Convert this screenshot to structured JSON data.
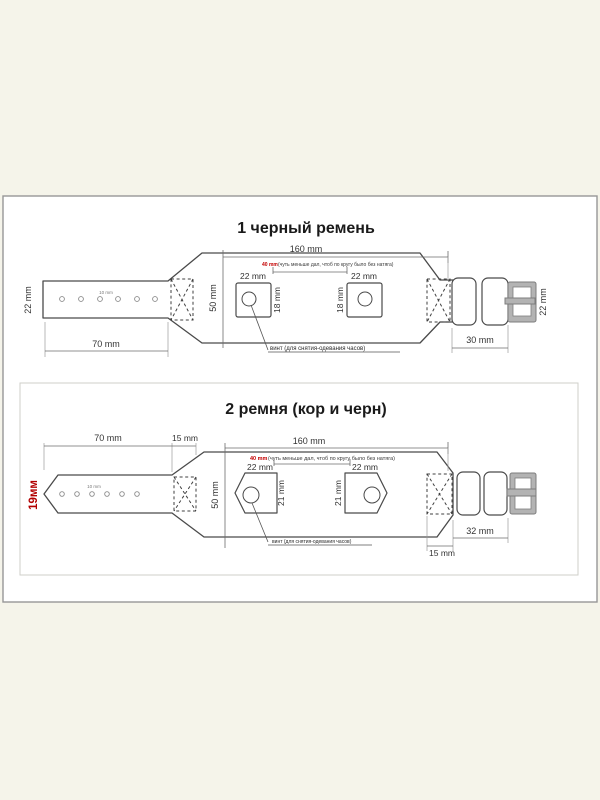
{
  "page": {
    "background_color": "#F5F4EA",
    "accent_red": "#C40000"
  },
  "diagram1": {
    "title": "1 черный ремень",
    "labels": {
      "left_strap_width": "22 mm",
      "hole_spacing": "10 mm",
      "tail_length": "70 mm",
      "total_length": "160 mm",
      "body_height": "50 mm",
      "pad1_width": "22 mm",
      "pad2_width": "22 mm",
      "pad1_height": "18 mm",
      "pad2_height": "18 mm",
      "gap_value": "40 mm",
      "gap_note": "(чуть меньше дал, чтоб по кругу было без натяга)",
      "screw_note": "винт (для снятия-одевания часов)",
      "buckle_section_length": "30 mm",
      "buckle_width": "22 mm"
    }
  },
  "diagram2": {
    "title": "2 ремня (кор и черн)",
    "labels": {
      "left_strap_width": "19мм",
      "tail_length": "70 mm",
      "stitch_zone_top": "15 mm",
      "hole_spacing": "10 mm",
      "total_length": "160 mm",
      "body_height": "50 mm",
      "pad1_width": "22 mm",
      "pad2_width": "22 mm",
      "pad1_height": "21 mm",
      "pad2_height": "21 mm",
      "gap_value": "40 mm",
      "gap_note": "(чуть меньше дал, чтоб по кругу было без натяга)",
      "screw_note": "винт (для снятия-одевания часов)",
      "buckle_section_length": "32 mm",
      "stitch_zone_bottom": "15 mm"
    }
  }
}
